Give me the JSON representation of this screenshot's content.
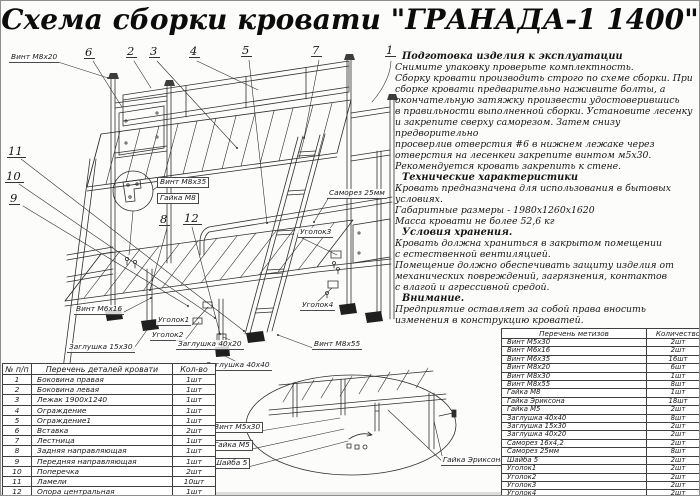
{
  "title": "Схема сборки кровати \"ГРАНАДА-1 1400\"",
  "colors": {
    "ink": "#2f2f2f",
    "paper": "#fcfcfb"
  },
  "callouts": {
    "c1": "1",
    "c2": "2",
    "c3": "3",
    "c4": "4",
    "c5": "5",
    "c6": "6",
    "c7": "7",
    "c8": "8",
    "c9": "9",
    "c10": "10",
    "c11": "11",
    "c12": "12"
  },
  "drawing_labels": {
    "vint_m8x20": "Винт М8х20",
    "vint_m8x35": "Винт М8х35",
    "gaika_m8": "Гайка М8",
    "samorez_25mm": "Саморез 25мм",
    "ugolok3": "Уголок3",
    "ugolok4": "Уголок4",
    "vint_m8x55": "Винт М8х55",
    "vint_m6x16": "Винт М6х16",
    "ugolok1": "Уголок1",
    "ugolok2": "Уголок2",
    "zaglushka_15x30": "Заглушка 15х30",
    "zaglushka_40x20": "Заглушка 40х20",
    "zaglushka_40x40": "Заглушка 40х40",
    "vint_m5x30": "Винт М5х30",
    "gaika_m5": "Гайка М5",
    "shaiba_5": "Шайба 5",
    "gaika_eriksona": "Гайка Эриксона"
  },
  "instructions": {
    "sections": [
      {
        "heading": "Подготовка изделия к эксплуатации",
        "lines": [
          "Снимите упаковку проверьте комплектность.",
          "Сборку кровати производить строго по схеме сборки. При",
          "сборке кровати  предварительно наживите  болты, а",
          "окончательную затяжку произвести удостоверившись",
          "в правильности выполненной сборки. Установите лесенку",
          "и закрепите сверху саморезом. Затем снизу предворительно",
          "просверлив отверстия #6 в нижнем лежаке через",
          "отверстия на лесенкеи закрепите винтом м5х30.",
          "Рекомендуется кровать закрепить к стене."
        ]
      },
      {
        "heading": "Технические характеристики",
        "lines": [
          "Кровать предназначена для использования в бытовых",
          "условиях.",
          "Габаритные размеры - 1980х1260х1620",
          "Масса кровати не более 52,6 кг"
        ]
      },
      {
        "heading": "Условия хранения.",
        "lines": [
          "Кровать должна храниться в закрытом помещении",
          "с естественной вентиляцией.",
          "Помещение должно обеспечивать защиту изделия от",
          "механических повреждений, загрязнения, контактов",
          "с влагой и агрессивной средой."
        ]
      },
      {
        "heading": "Внимание.",
        "lines": [
          "Предприятие оставляет за собой права вносить",
          "изменения в конструкцию кроватей."
        ]
      }
    ]
  },
  "parts_table": {
    "headers": [
      "№ п/п",
      "Перечень деталей кровати",
      "Кол-во"
    ],
    "rows": [
      {
        "num": "1",
        "name": "Боковина правая",
        "qty": "1шт"
      },
      {
        "num": "2",
        "name": "Боковина левая",
        "qty": "1шт"
      },
      {
        "num": "3",
        "name": "Лежак 1900х1240",
        "qty": "1шт"
      },
      {
        "num": "4",
        "name": "Ограждение",
        "qty": "1шт"
      },
      {
        "num": "5",
        "name": "Ограждение1",
        "qty": "1шт"
      },
      {
        "num": "6",
        "name": "Вставка",
        "qty": "2шт"
      },
      {
        "num": "7",
        "name": "Лестница",
        "qty": "1шт"
      },
      {
        "num": "8",
        "name": "Задняя направляющая",
        "qty": "1шт"
      },
      {
        "num": "9",
        "name": "Передняя направляющая",
        "qty": "1шт"
      },
      {
        "num": "10",
        "name": "Поперечка",
        "qty": "2шт"
      },
      {
        "num": "11",
        "name": "Ламели",
        "qty": "10шт"
      },
      {
        "num": "12",
        "name": "Опора центральная",
        "qty": "1шт"
      }
    ]
  },
  "hardware_table": {
    "headers": [
      "Перечень метизов",
      "Количество"
    ],
    "rows": [
      {
        "name": "Винт М5х30",
        "qty": "2шт"
      },
      {
        "name": "Винт М6х16",
        "qty": "2шт"
      },
      {
        "name": "Винт М6х35",
        "qty": "16шт"
      },
      {
        "name": "Винт М8х20",
        "qty": "6шт"
      },
      {
        "name": "Винт М8х30",
        "qty": "1шт"
      },
      {
        "name": "Винт М8х55",
        "qty": "8шт"
      },
      {
        "name": "Гайка М8",
        "qty": "1шт"
      },
      {
        "name": "Гайка Эриксона",
        "qty": "18шт"
      },
      {
        "name": "Гайка М5",
        "qty": "2шт"
      },
      {
        "name": "Заглушка 40х40",
        "qty": "8шт"
      },
      {
        "name": "Заглушка 15х30",
        "qty": "2шт"
      },
      {
        "name": "Заглушка 40х20",
        "qty": "2шт"
      },
      {
        "name": "Саморез 16х4,2",
        "qty": "2шт"
      },
      {
        "name": "Саморез 25мм",
        "qty": "8шт"
      },
      {
        "name": "Шайба 5",
        "qty": "2шт"
      },
      {
        "name": "Уголок1",
        "qty": "2шт"
      },
      {
        "name": "Уголок2",
        "qty": "2шт"
      },
      {
        "name": "Уголок3",
        "qty": "2шт"
      },
      {
        "name": "Уголок4",
        "qty": "2шт"
      }
    ]
  }
}
